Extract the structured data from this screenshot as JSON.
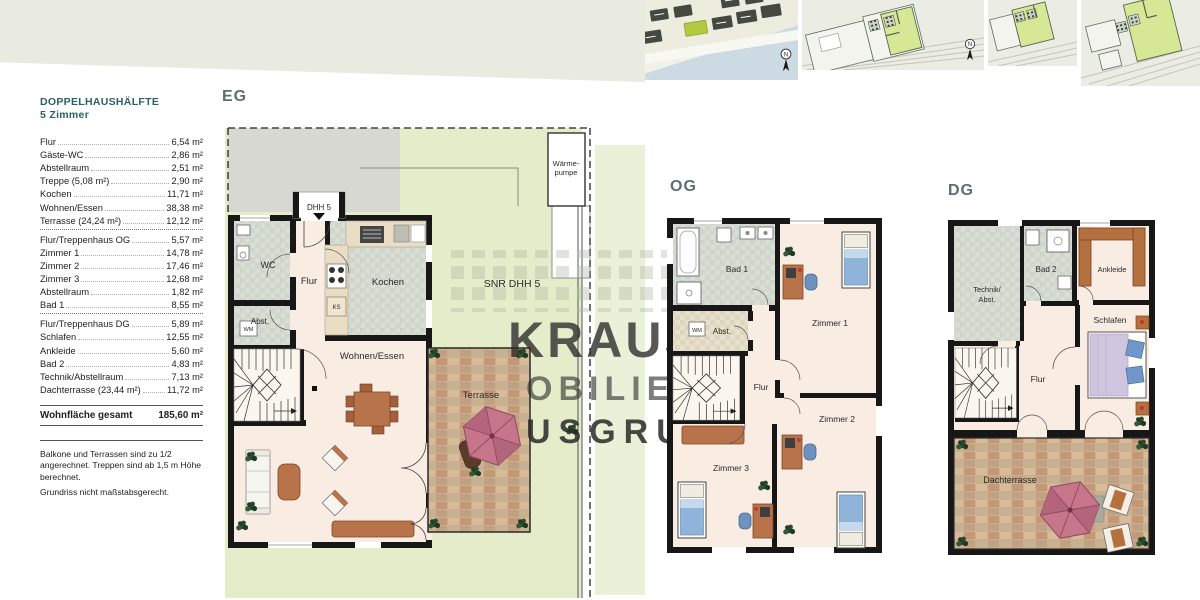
{
  "info_panel": {
    "title_line1": "DOPPELHAUSHÄLFTE",
    "title_line2": "5 Zimmer",
    "rows": [
      {
        "label": "Flur",
        "value": "6,54 m²"
      },
      {
        "label": "Gäste-WC",
        "value": "2,86 m²"
      },
      {
        "label": "Abstellraum",
        "value": "2,51 m²"
      },
      {
        "label": "Treppe (5,08 m²)",
        "value": "2,90 m²"
      },
      {
        "label": "Kochen",
        "value": "11,71 m²"
      },
      {
        "label": "Wohnen/Essen",
        "value": "38,38 m²"
      },
      {
        "label": "Terrasse (24,24 m²)",
        "value": "12,12 m²"
      },
      {
        "label": "Flur/Treppenhaus OG",
        "value": "5,57 m²"
      },
      {
        "label": "Zimmer 1",
        "value": "14,78 m²"
      },
      {
        "label": "Zimmer 2",
        "value": "17,46 m²"
      },
      {
        "label": "Zimmer 3",
        "value": "12,68 m²"
      },
      {
        "label": "Abstellraum",
        "value": "1,82 m²"
      },
      {
        "label": "Bad 1",
        "value": "8,55 m²"
      },
      {
        "label": "Flur/Treppenhaus DG",
        "value": "5,89 m²"
      },
      {
        "label": "Schlafen",
        "value": "12,55 m²"
      },
      {
        "label": "Ankleide",
        "value": "5,60 m²"
      },
      {
        "label": "Bad 2",
        "value": "4,83 m²"
      },
      {
        "label": "Technik/Abstellraum",
        "value": "7,13 m²"
      },
      {
        "label": "Dachterrasse (23,44 m²)",
        "value": "11,72 m²"
      }
    ],
    "total_label": "Wohnfläche gesamt",
    "total_value": "185,60 m²",
    "note1": "Balkone und Terrassen sind zu 1/2 angerechnet. Treppen sind ab 1,5 m Höhe berechnet.",
    "note2": "Grundriss nicht maßstabsgerecht."
  },
  "watermark": {
    "line1": "KRAUS",
    "line2": "OBILIENG",
    "line3": "USGRUPP"
  },
  "compass": {
    "label": "N"
  },
  "plans": {
    "eg": {
      "title": "EG",
      "entrance_label": "DHH 5",
      "site_label": "SNR DHH 5",
      "heat_pump_line1": "Wärme-",
      "heat_pump_line2": "pumpe",
      "rooms": {
        "wc": "WC",
        "abst": "Abst.",
        "flur": "Flur",
        "kochen": "Kochen",
        "wohnen": "Wohnen/Essen",
        "terrasse": "Terrasse"
      },
      "appliances": {
        "wm": "WM",
        "ks": "KS"
      }
    },
    "og": {
      "title": "OG",
      "rooms": {
        "bad": "Bad 1",
        "abst": "Abst.",
        "flur": "Flur",
        "zimmer1": "Zimmer 1",
        "zimmer2": "Zimmer 2",
        "zimmer3": "Zimmer 3"
      },
      "appliances": {
        "wm": "WM"
      }
    },
    "dg": {
      "title": "DG",
      "rooms": {
        "technik_line1": "Technik/",
        "technik_line2": "Abst.",
        "bad": "Bad 2",
        "ankleide": "Ankleide",
        "schlafen": "Schlafen",
        "flur": "Flur",
        "dachterrasse": "Dachterrasse"
      }
    }
  }
}
